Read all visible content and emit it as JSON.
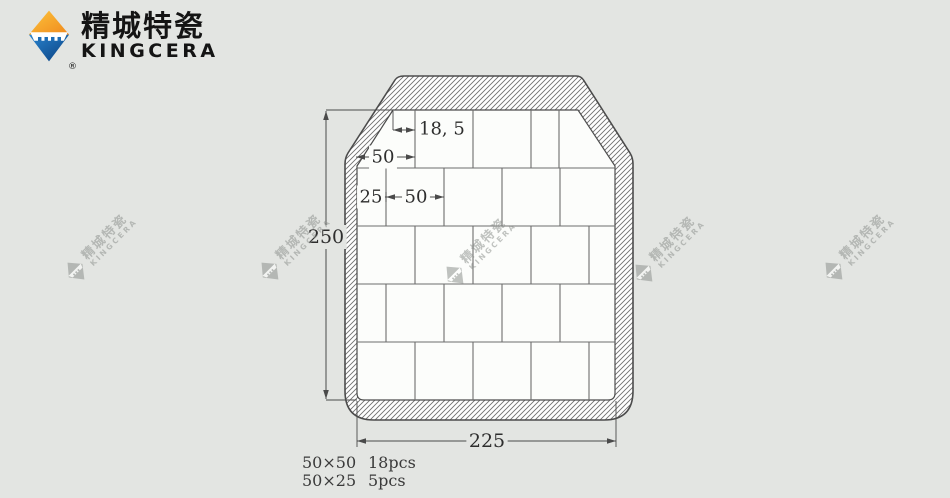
{
  "page": {
    "width": 950,
    "height": 498,
    "bg": "#e3e5e2"
  },
  "brand": {
    "name_cn": "精城特瓷",
    "name_en": "KINGCERA",
    "registered": "®",
    "colors": {
      "orange_light": "#fcc43c",
      "orange": "#f0891d",
      "blue": "#2a85d0",
      "blue_dark": "#0a3f7e",
      "text": "#141414"
    }
  },
  "watermarks": {
    "text_cn": "精城特瓷",
    "text_en": "KINGCERA",
    "color": "#8f938f",
    "opacity": 0.55,
    "positions": [
      {
        "x": 100,
        "y": 247
      },
      {
        "x": 294,
        "y": 247
      },
      {
        "x": 479,
        "y": 251
      },
      {
        "x": 668,
        "y": 249
      },
      {
        "x": 858,
        "y": 247
      }
    ]
  },
  "diagram": {
    "colors": {
      "line": "#4c4c4c",
      "tile_line": "#6d6d6d",
      "tile_fill": "#fcfdfb",
      "hatch_line": "#707070",
      "dim": "#4a4a4a",
      "text": "#2e2e2e",
      "page_bg": "#e3e5e2"
    },
    "plate": {
      "outer_path": "M 404,76 L 576,76 Q 581,76 583.5,80 L 630,153 Q 633,158 633,164 L 633,391 Q 633,420 604,420 L 374,420 Q 345,420 345,391 L 345,164 Q 345,158 348,153 L 395,80 Q 397.5,76 404,76 Z",
      "inner_path": "M 393,110 L 578,110 L 615,166 L 615,393 Q 615,400 608,400 L 364,400 Q 357,400 357,393 L 357,166 Z"
    },
    "grid": {
      "x0": 357,
      "x1": 615,
      "row_lines": [
        168,
        226,
        284,
        342
      ],
      "rows": [
        {
          "y1": 110,
          "y2": 168,
          "xs": [
            415,
            473,
            531,
            559
          ]
        },
        {
          "y1": 168,
          "y2": 226,
          "xs": [
            386,
            444,
            502,
            560
          ]
        },
        {
          "y1": 226,
          "y2": 284,
          "xs": [
            415,
            473,
            531,
            589
          ]
        },
        {
          "y1": 284,
          "y2": 342,
          "xs": [
            386,
            444,
            502,
            560
          ]
        },
        {
          "y1": 342,
          "y2": 400,
          "xs": [
            415,
            473,
            531,
            589
          ]
        }
      ]
    },
    "dimensions": [
      {
        "id": "height-250",
        "label": "250",
        "orient": "v",
        "x": 326,
        "y1": 111,
        "y2": 399,
        "ext": [
          [
            326,
            110,
            393,
            110
          ],
          [
            326,
            400,
            357,
            400
          ]
        ],
        "label_x": 326,
        "label_y": 237,
        "bg": "page",
        "font": 19
      },
      {
        "id": "width-225",
        "label": "225",
        "orient": "h",
        "y": 441,
        "x1": 357,
        "x2": 616,
        "ext": [
          [
            357,
            401,
            357,
            447
          ],
          [
            616,
            401,
            616,
            447
          ]
        ],
        "label_x": 487,
        "label_y": 441,
        "bg": "page",
        "font": 19
      },
      {
        "id": "offset-18-5",
        "label": "18, 5",
        "orient": "h",
        "y": 130,
        "x1": 393,
        "x2": 415,
        "ext": [
          [
            393,
            111,
            393,
            130
          ]
        ],
        "label_x": 419,
        "label_y": 129,
        "bg": "none",
        "anchor": "start",
        "font": 18
      },
      {
        "id": "tile-50-row1",
        "label": "50",
        "orient": "h",
        "y": 157,
        "x1": 356,
        "x2": 415,
        "ext": [],
        "label_x": 383,
        "label_y": 157,
        "bg": "tile",
        "font": 18
      },
      {
        "id": "tile-25-row2",
        "label": "25",
        "orient": "h",
        "y": 197,
        "x1": 357,
        "x2": 386,
        "ext": [],
        "label_x": 371,
        "label_y": 197,
        "bg": "tile",
        "font": 18
      },
      {
        "id": "tile-50-row2",
        "label": "50",
        "orient": "h",
        "y": 197,
        "x1": 386,
        "x2": 444,
        "ext": [
          [
            386,
            192,
            386,
            202
          ]
        ],
        "label_x": 416,
        "label_y": 197,
        "bg": "tile",
        "font": 18
      }
    ]
  },
  "legend": {
    "rows": [
      {
        "size": "50×50",
        "count": "18pcs"
      },
      {
        "size": "50×25",
        "count": "5pcs"
      }
    ]
  }
}
